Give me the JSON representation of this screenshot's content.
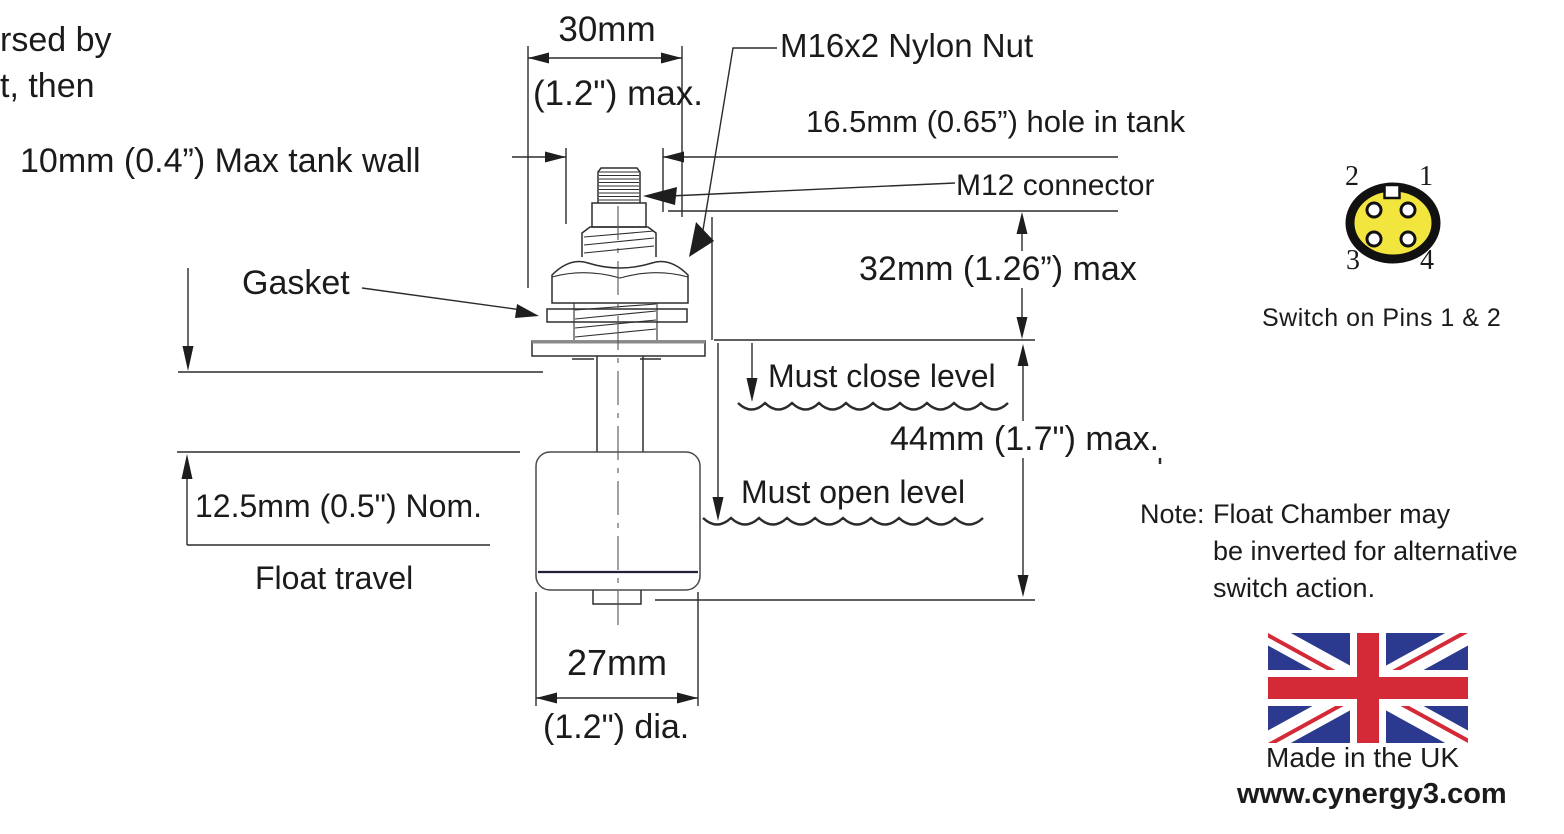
{
  "clipped_text": {
    "line1": "rsed by",
    "line2": "t, then"
  },
  "dimensions": {
    "tank_wall": "10mm (0.4”) Max tank wall",
    "width_mm": "30mm",
    "width_in": "(1.2\") max.",
    "nylon_nut": "M16x2 Nylon Nut",
    "hole_in_tank": "16.5mm (0.65”) hole in tank",
    "m12_connector": "M12 connector",
    "close_height": "32mm (1.26”) max",
    "gasket": "Gasket",
    "must_close": "Must close level",
    "open_height": "44mm (1.7\") max.",
    "must_open": "Must open level",
    "float_travel_value": "12.5mm (0.5\") Nom.",
    "float_travel_label": "Float travel",
    "float_dia_mm": "27mm",
    "float_dia_in": "(1.2\") dia."
  },
  "connector_diagram": {
    "caption": "Switch on Pins 1 & 2",
    "body_color": "#F2E53E",
    "pins": {
      "p1": "1",
      "p2": "2",
      "p3": "3",
      "p4": "4"
    }
  },
  "note": {
    "label": "Note:",
    "line1": "Float Chamber may",
    "line2": "be inverted for alternative",
    "line3": "switch action."
  },
  "footer": {
    "made_in": "Made in the UK",
    "website": "www.cynergy3.com"
  },
  "flag_colors": {
    "blue": "#2B3A8F",
    "red": "#D42A38"
  }
}
